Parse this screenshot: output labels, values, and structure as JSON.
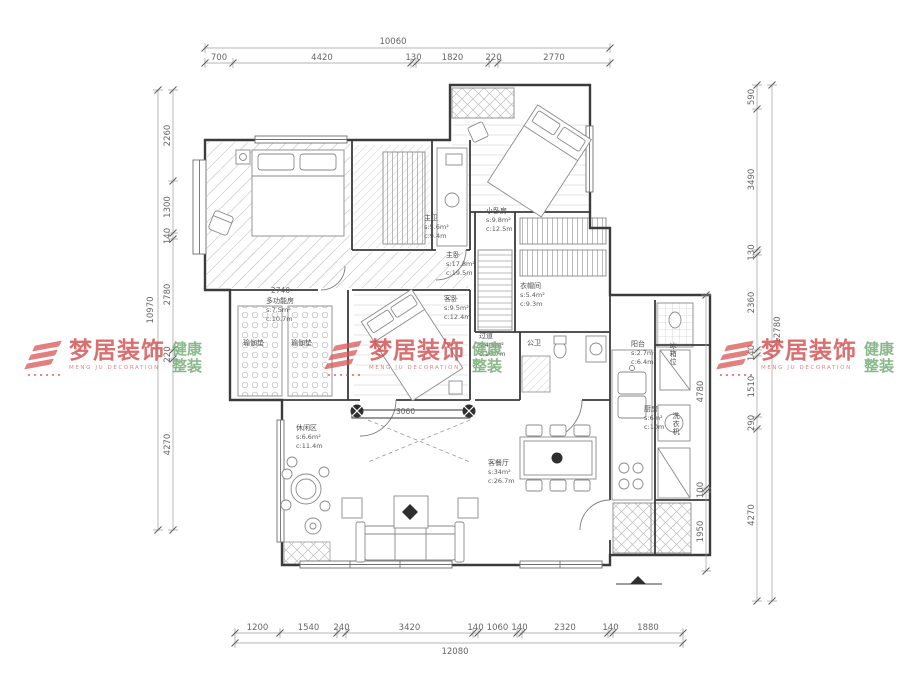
{
  "drawing": {
    "type": "residential-floor-plan",
    "line_color": "#3b3b3b",
    "dim_color": "#9b9b9b",
    "watermark_red": "#d34f4f",
    "watermark_green": "#74ac74"
  },
  "watermark": {
    "brand": "梦居装饰",
    "brand_en": "MENG JU DECORATION",
    "tagline_line1": "健康",
    "tagline_line2": "整装"
  },
  "rooms": [
    {
      "name": "主卫",
      "area": "s:5.6m²",
      "len": "c:9.4m",
      "x": 424,
      "y": 214
    },
    {
      "name": "小卧房",
      "area": "s:9.8m²",
      "len": "c:12.5m",
      "x": 486,
      "y": 207
    },
    {
      "name": "主卧",
      "area": "s:17.8m²",
      "len": "c:19.5m",
      "x": 446,
      "y": 251
    },
    {
      "name": "衣帽间",
      "area": "s:5.4m²",
      "len": "c:9.3m",
      "x": 520,
      "y": 282
    },
    {
      "name": "多功能房",
      "area": "s:7.5m²",
      "len": "c:10.7m",
      "x": 266,
      "y": 297
    },
    {
      "name": "客卧",
      "area": "s:9.5m²",
      "len": "c:12.4m",
      "x": 444,
      "y": 295
    },
    {
      "name": "过道",
      "area": "s:4.5m²",
      "len": "c:10.7m",
      "x": 479,
      "y": 332
    },
    {
      "name": "公卫",
      "x": 527,
      "y": 339
    },
    {
      "name": "阳台",
      "area": "s:2.7m²",
      "len": "c:6.4m",
      "x": 631,
      "y": 340
    },
    {
      "name": "厨房",
      "area": "s:6m²",
      "len": "c:10m",
      "x": 644,
      "y": 405
    },
    {
      "name": "客餐厅",
      "area": "s:34m²",
      "len": "c:26.7m",
      "x": 488,
      "y": 459
    },
    {
      "name": "休闲区",
      "area": "s:6.6m²",
      "len": "c:11.4m",
      "x": 296,
      "y": 424
    },
    {
      "name": "瑜伽垫",
      "x": 243,
      "y": 339
    },
    {
      "name": "瑜伽垫",
      "x": 291,
      "y": 339
    },
    {
      "name": "冰箱位",
      "x": 668,
      "y": 342,
      "vertical": true
    },
    {
      "name": "洗衣机",
      "x": 671,
      "y": 412,
      "vertical": true
    }
  ],
  "notes": [
    {
      "text": "2740",
      "x": 271,
      "y": 286
    },
    {
      "text": "3060",
      "x": 396,
      "y": 407
    }
  ],
  "dimensions": {
    "chains": [
      {
        "id": "top-total",
        "orient": "h",
        "pos": 48,
        "from": 205,
        "to": 610,
        "label": "10060",
        "lx": 393,
        "ly": 44
      },
      {
        "id": "top-segments",
        "orient": "h",
        "pos": 63,
        "bounds": [
          205,
          233,
          411,
          416,
          489,
          498,
          610
        ],
        "values": [
          "700",
          "4420",
          "130",
          "1820",
          "220",
          "2770"
        ]
      },
      {
        "id": "bottom-segments",
        "orient": "h",
        "pos": 633,
        "bounds": [
          235,
          280,
          337,
          346,
          473,
          478,
          517,
          522,
          608,
          613,
          683
        ],
        "values": [
          "1200",
          "1540",
          "240",
          "3420",
          "140",
          "1060",
          "140",
          "2320",
          "140",
          "1880"
        ]
      },
      {
        "id": "bottom-total",
        "orient": "h",
        "pos": 643,
        "from": 235,
        "to": 683,
        "label": "12080",
        "lx": 455,
        "ly": 654
      },
      {
        "id": "left-total",
        "orient": "v",
        "pos": 158,
        "from": 90,
        "to": 530,
        "label": "10970",
        "lx": 153,
        "ly": 310
      },
      {
        "id": "left-segments",
        "orient": "v",
        "pos": 173,
        "bounds": [
          90,
          181,
          233,
          239,
          350,
          359,
          530
        ],
        "values": [
          "2260",
          "1300",
          "140",
          "2780",
          "220",
          "4270"
        ]
      },
      {
        "id": "right-segments",
        "orient": "v",
        "pos": 757,
        "bounds": [
          85,
          109,
          250,
          255,
          350,
          356,
          417,
          429,
          601
        ],
        "values": [
          "590",
          "3490",
          "130",
          "2360",
          "140",
          "1510",
          "290",
          "4270"
        ]
      },
      {
        "id": "right-total",
        "orient": "v",
        "pos": 772,
        "from": 85,
        "to": 601,
        "label": "12780",
        "lx": 780,
        "ly": 330
      },
      {
        "id": "right-inner",
        "orient": "v",
        "pos": 706,
        "bounds": [
          295,
          488,
          492,
          571
        ],
        "values": [
          "4780",
          "100",
          "1950"
        ]
      }
    ]
  }
}
